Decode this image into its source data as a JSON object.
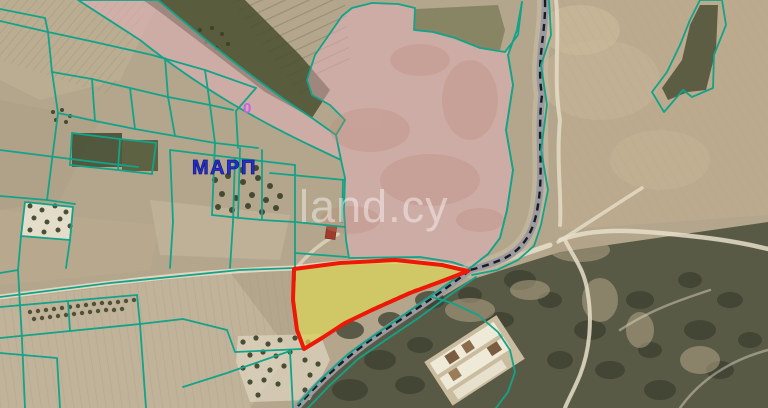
{
  "map": {
    "labels": {
      "area_name": "ΜΑΡΠ",
      "road_number": "0",
      "watermark": "land.cy"
    },
    "colors": {
      "parcel_line": "#12a389",
      "plot_border": "#ee1806",
      "plot_fill": "#d9d35a",
      "zone_fill": "#e7b2bf",
      "stream_band": "#9a9aa0",
      "stream_dash": "#1a1a22",
      "area_label": "#2530cf",
      "road_label": "#c95fe8",
      "watermark": "#ffffff"
    }
  }
}
